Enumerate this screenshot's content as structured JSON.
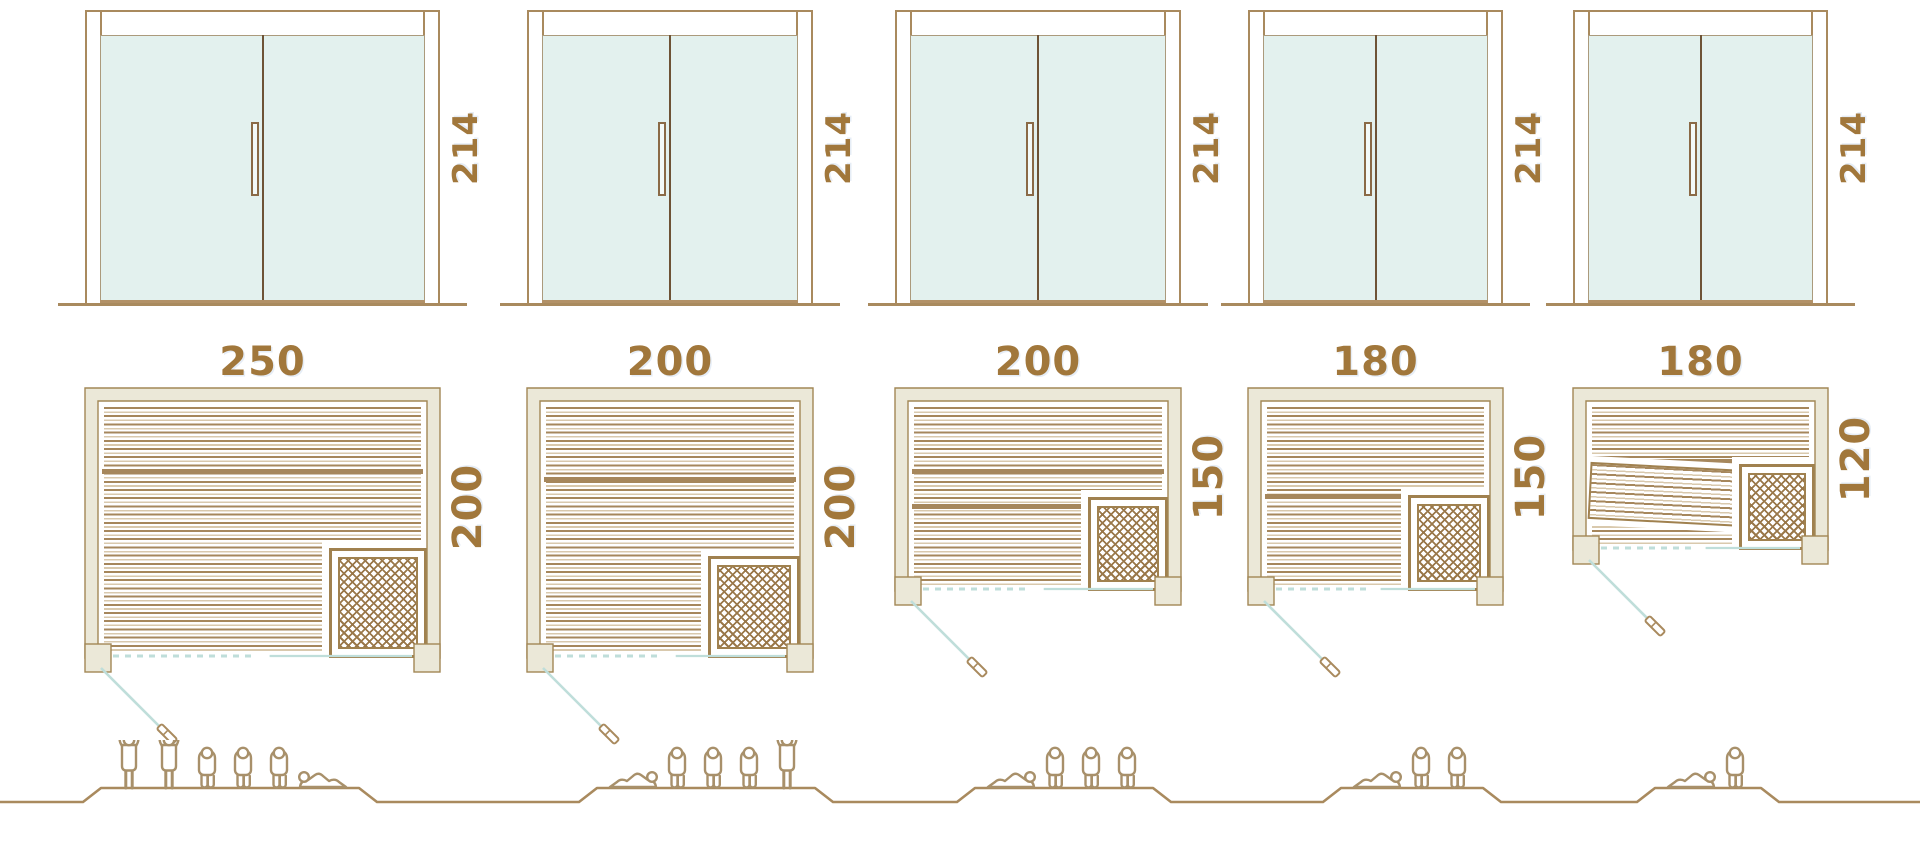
{
  "units": [
    {
      "door": {
        "height_label": "214"
      },
      "plan": {
        "width_label": "250",
        "height_label": "200"
      },
      "capacity": {
        "count": 6,
        "figures": [
          "standing",
          "standing",
          "sitting",
          "sitting",
          "sitting",
          "lying_mirrored"
        ]
      }
    },
    {
      "door": {
        "height_label": "214"
      },
      "plan": {
        "width_label": "200",
        "height_label": "200"
      },
      "capacity": {
        "count": 5,
        "figures": [
          "lying",
          "sitting",
          "sitting",
          "sitting",
          "standing"
        ]
      }
    },
    {
      "door": {
        "height_label": "214"
      },
      "plan": {
        "width_label": "200",
        "height_label": "150"
      },
      "capacity": {
        "count": 4,
        "figures": [
          "lying",
          "sitting",
          "sitting",
          "sitting"
        ]
      }
    },
    {
      "door": {
        "height_label": "214"
      },
      "plan": {
        "width_label": "180",
        "height_label": "150"
      },
      "capacity": {
        "count": 3,
        "figures": [
          "lying",
          "sitting",
          "sitting"
        ]
      }
    },
    {
      "door": {
        "height_label": "214"
      },
      "plan": {
        "width_label": "180",
        "height_label": "120"
      },
      "capacity": {
        "count": 2,
        "figures": [
          "lying",
          "sitting"
        ]
      }
    }
  ],
  "colors": {
    "line_brown": "#a98a5e",
    "dark_brown": "#6e5336",
    "text_brown": "#a1773b",
    "wall_fill": "#ebe8d8",
    "wall_stroke": "#a28756",
    "glass_fill": "#e3f1ee",
    "teal_line": "#bfdeda",
    "lattice_brown": "#9a784a",
    "slat_light": "#d9c9ad",
    "figure_outline": "#a8906a"
  }
}
